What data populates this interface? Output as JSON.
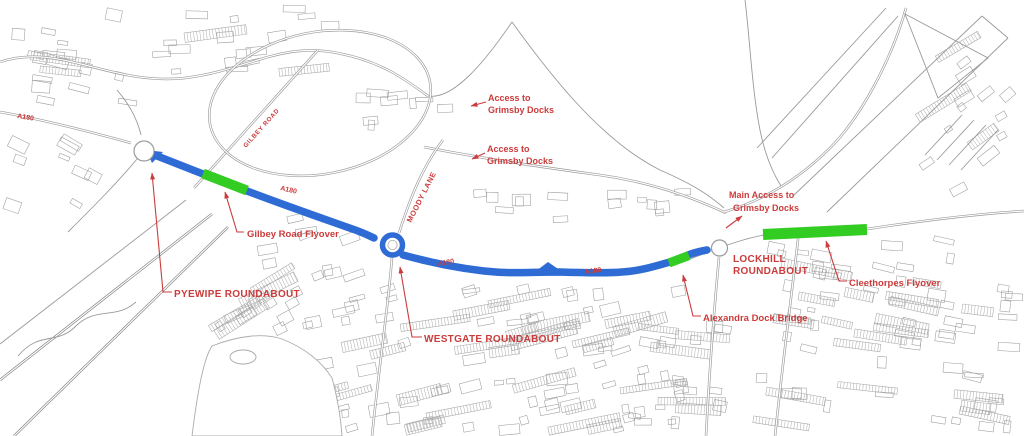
{
  "colors": {
    "route_blue": "#2e6bd4",
    "highlight_green": "#33cc22",
    "annotation_red": "#cb3b3b",
    "linework_gray": "#9a9a9a",
    "linework_dark": "#7f7f7f"
  },
  "a180_labels": [
    "A180",
    "A180",
    "A180",
    "A180"
  ],
  "road_names": {
    "gilbey_road": "GILBEY ROAD",
    "moody_lane": "MOODY LANE"
  },
  "annotations": {
    "access_north": {
      "line1": "Access to",
      "line2": "Grimsby Docks"
    },
    "access_mid": {
      "line1": "Access to",
      "line2": "Grimsby Docks"
    },
    "main_access": {
      "line1": "Main Access to",
      "line2": "Grimsby Docks"
    },
    "pyewipe": "PYEWIPE ROUNDABOUT",
    "westgate": "WESTGATE ROUNDABOUT",
    "lockhill": {
      "line1": "LOCKHILL",
      "line2": "ROUNDABOUT"
    },
    "gilbey_flyover": "Gilbey Road Flyover",
    "alexandra": "Alexandra Dock Bridge",
    "cleethorpes": "Cleethorpes Flyover"
  }
}
